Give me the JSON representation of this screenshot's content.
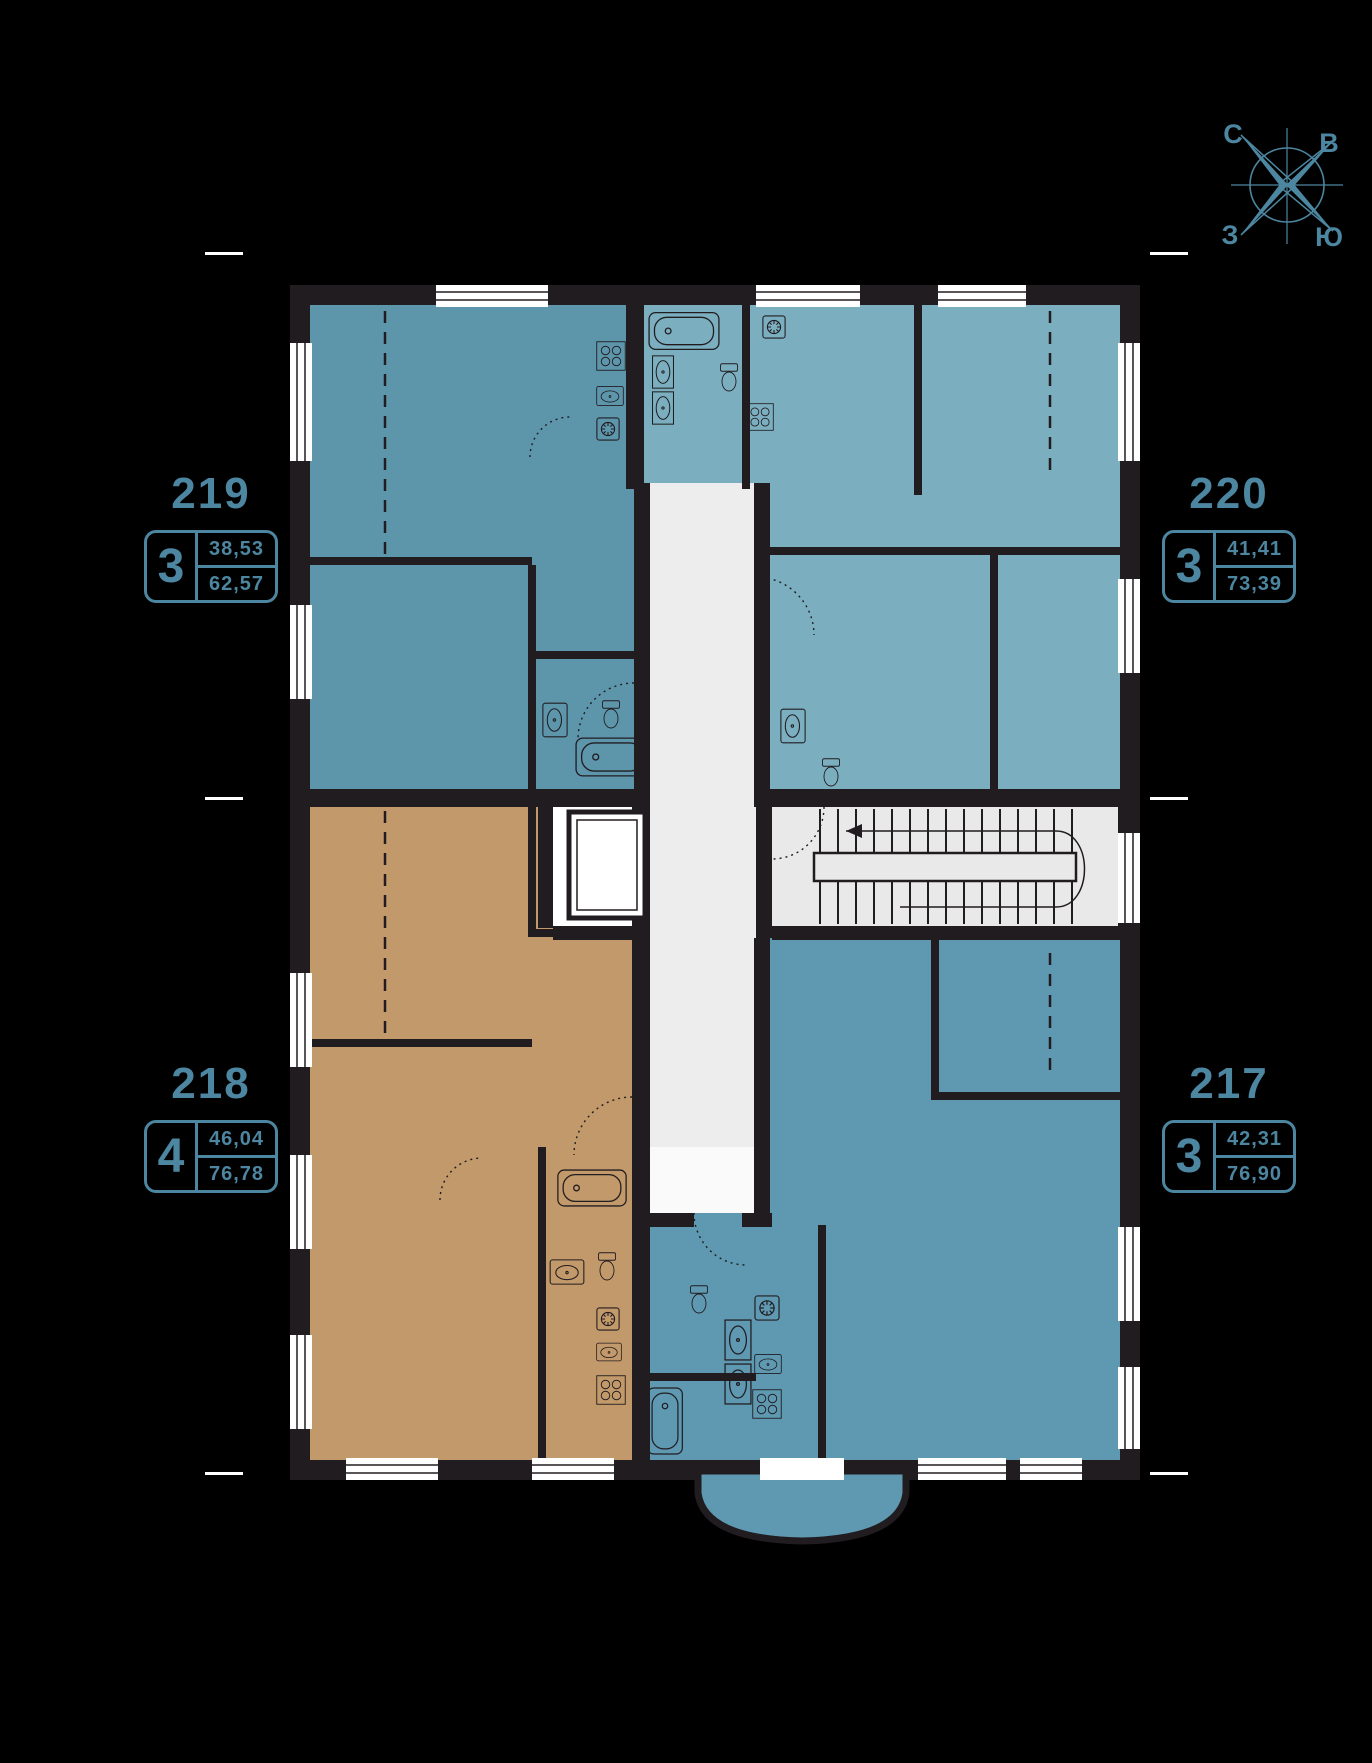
{
  "colors": {
    "background": "#000000",
    "accent": "#4c86a0",
    "wall": "#211c20",
    "corridor": "#ededed",
    "hall": "#e9e9e9"
  },
  "compass": {
    "north": "С",
    "east": "В",
    "west": "З",
    "south": "Ю"
  },
  "apartments": [
    {
      "number": "219",
      "rooms": "3",
      "area_upper": "38,53",
      "area_lower": "62,57",
      "color": "#5d96ab",
      "position": "top-left"
    },
    {
      "number": "220",
      "rooms": "3",
      "area_upper": "41,41",
      "area_lower": "73,39",
      "color": "#7bafc0",
      "position": "top-right"
    },
    {
      "number": "218",
      "rooms": "4",
      "area_upper": "46,04",
      "area_lower": "76,78",
      "color": "#c2996a",
      "position": "bottom-left"
    },
    {
      "number": "217",
      "rooms": "3",
      "area_upper": "42,31",
      "area_lower": "76,90",
      "color": "#5e99b1",
      "position": "bottom-right"
    }
  ]
}
